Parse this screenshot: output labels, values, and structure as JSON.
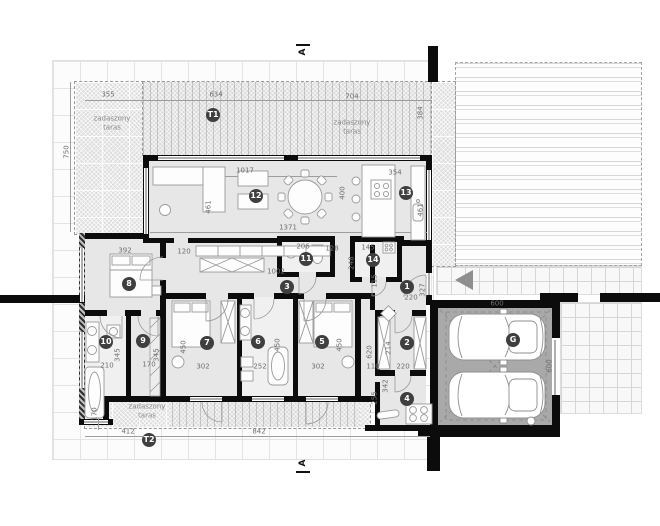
{
  "plan": {
    "terrace_label": "zadaszony taras",
    "section_label": "A",
    "palette": {
      "wall": "#0c0c0c",
      "floor": "#e7e7e7",
      "terrace": "#dcdcdc",
      "garage_floor": "#a9a9a9",
      "badge": "#3f3f3f",
      "dim_text": "#6f6f6f"
    }
  },
  "rooms": [
    {
      "label": "T1",
      "x": 213,
      "y": 115
    },
    {
      "label": "12",
      "x": 256,
      "y": 196
    },
    {
      "label": "13",
      "x": 406,
      "y": 193
    },
    {
      "label": "11",
      "x": 306,
      "y": 259
    },
    {
      "label": "14",
      "x": 373,
      "y": 260
    },
    {
      "label": "3",
      "x": 287,
      "y": 287
    },
    {
      "label": "1",
      "x": 407,
      "y": 287
    },
    {
      "label": "8",
      "x": 129,
      "y": 284
    },
    {
      "label": "10",
      "x": 106,
      "y": 342
    },
    {
      "label": "9",
      "x": 143,
      "y": 341
    },
    {
      "label": "7",
      "x": 207,
      "y": 343
    },
    {
      "label": "6",
      "x": 258,
      "y": 342
    },
    {
      "label": "5",
      "x": 322,
      "y": 342
    },
    {
      "label": "2",
      "x": 407,
      "y": 343
    },
    {
      "label": "4",
      "x": 407,
      "y": 399
    },
    {
      "label": "G",
      "x": 513,
      "y": 340
    },
    {
      "label": "T2",
      "x": 149,
      "y": 440
    }
  ],
  "dims": [
    {
      "text": "355",
      "x": 108,
      "y": 95,
      "v": false
    },
    {
      "text": "634",
      "x": 216,
      "y": 95,
      "v": false
    },
    {
      "text": "704",
      "x": 352,
      "y": 97,
      "v": false
    },
    {
      "text": "750",
      "x": 67,
      "y": 152,
      "v": true
    },
    {
      "text": "384",
      "x": 421,
      "y": 113,
      "v": true
    },
    {
      "text": "1017",
      "x": 245,
      "y": 171,
      "v": false
    },
    {
      "text": "461",
      "x": 209,
      "y": 207,
      "v": true
    },
    {
      "text": "1371",
      "x": 288,
      "y": 228,
      "v": false
    },
    {
      "text": "354",
      "x": 395,
      "y": 173,
      "v": false
    },
    {
      "text": "400",
      "x": 343,
      "y": 193,
      "v": true
    },
    {
      "text": "461",
      "x": 421,
      "y": 210,
      "v": true
    },
    {
      "text": "392",
      "x": 125,
      "y": 251,
      "v": false
    },
    {
      "text": "120",
      "x": 184,
      "y": 252,
      "v": false
    },
    {
      "text": "206",
      "x": 303,
      "y": 247,
      "v": false
    },
    {
      "text": "128",
      "x": 332,
      "y": 249,
      "v": false
    },
    {
      "text": "145",
      "x": 368,
      "y": 248,
      "v": false
    },
    {
      "text": "248",
      "x": 352,
      "y": 263,
      "v": true
    },
    {
      "text": "1002",
      "x": 276,
      "y": 272,
      "v": false
    },
    {
      "text": "115",
      "x": 375,
      "y": 281,
      "v": true
    },
    {
      "text": "220",
      "x": 411,
      "y": 298,
      "v": false
    },
    {
      "text": "327",
      "x": 423,
      "y": 290,
      "v": true
    },
    {
      "text": "302",
      "x": 203,
      "y": 367,
      "v": false
    },
    {
      "text": "450",
      "x": 184,
      "y": 347,
      "v": true
    },
    {
      "text": "252",
      "x": 260,
      "y": 367,
      "v": false
    },
    {
      "text": "450",
      "x": 278,
      "y": 345,
      "v": true
    },
    {
      "text": "302",
      "x": 318,
      "y": 367,
      "v": false
    },
    {
      "text": "450",
      "x": 340,
      "y": 345,
      "v": true
    },
    {
      "text": "110",
      "x": 373,
      "y": 367,
      "v": false
    },
    {
      "text": "620",
      "x": 370,
      "y": 352,
      "v": true
    },
    {
      "text": "214",
      "x": 389,
      "y": 348,
      "v": true
    },
    {
      "text": "220",
      "x": 403,
      "y": 367,
      "v": false
    },
    {
      "text": "342",
      "x": 386,
      "y": 386,
      "v": true
    },
    {
      "text": "255",
      "x": 375,
      "y": 398,
      "v": true
    },
    {
      "text": "210",
      "x": 107,
      "y": 366,
      "v": false
    },
    {
      "text": "345",
      "x": 118,
      "y": 355,
      "v": true
    },
    {
      "text": "170",
      "x": 149,
      "y": 365,
      "v": false
    },
    {
      "text": "345",
      "x": 157,
      "y": 355,
      "v": true
    },
    {
      "text": "170",
      "x": 95,
      "y": 414,
      "v": true
    },
    {
      "text": "412",
      "x": 128,
      "y": 432,
      "v": false
    },
    {
      "text": "842",
      "x": 259,
      "y": 432,
      "v": false
    },
    {
      "text": "600",
      "x": 497,
      "y": 304,
      "v": false
    },
    {
      "text": "600",
      "x": 550,
      "y": 366,
      "v": true
    }
  ],
  "areas": [
    {
      "text": "zadaszony taras",
      "x": 112,
      "y": 124,
      "w": 48
    },
    {
      "text": "zadaszony taras",
      "x": 352,
      "y": 128,
      "w": 52
    },
    {
      "text": "zadaszony taras",
      "x": 147,
      "y": 412,
      "w": 48
    }
  ],
  "sections": [
    {
      "label": "A",
      "x": 303,
      "y": 52,
      "bar_y": 44
    },
    {
      "label": "A",
      "x": 303,
      "y": 463,
      "bar_y": 471
    }
  ]
}
